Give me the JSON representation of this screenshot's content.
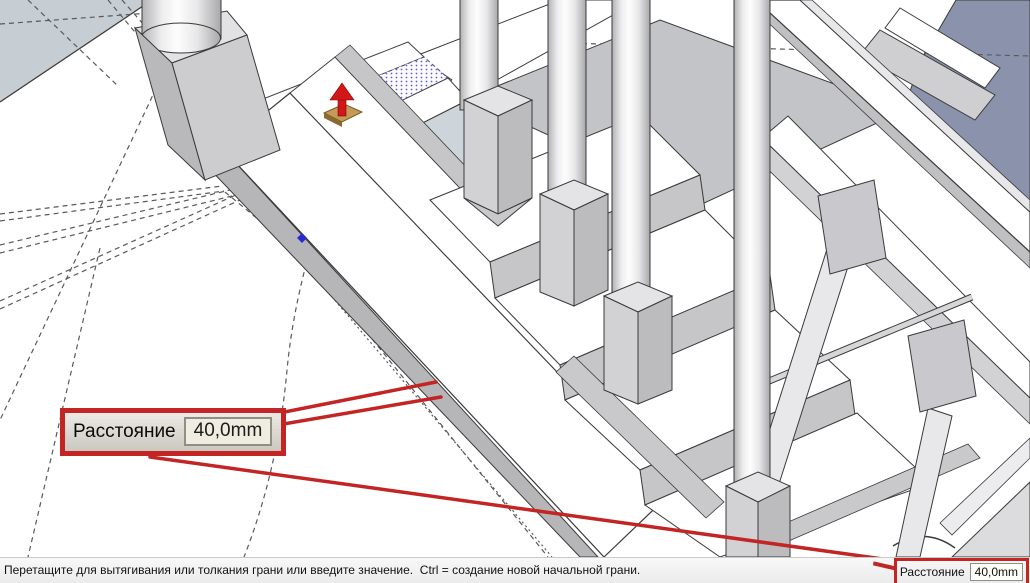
{
  "callout": {
    "label": "Расстояние",
    "value": "40,0mm"
  },
  "status_bar": {
    "message": "Перетащите для вытягивания или толкания грани или введите значение.  Ctrl = создание новой начальной грани.",
    "vcb": {
      "label": "Расстояние",
      "value": "40,0mm"
    }
  },
  "icons": {
    "push_pull_cursor": "push-pull-cursor-icon",
    "inference_point": "inference-point-icon"
  },
  "colors": {
    "annotation_red": "#c32424",
    "selection_dot_blue": "#4646c8",
    "inference_blue": "#2a2ad0",
    "face_white": "#ffffff",
    "face_gray": "#c6c6c9",
    "back_face_slate": "#8a93ab",
    "corner_face_light": "#c6cdd3",
    "landing_blue": "#cdd5da",
    "edge": "#3a3a3a",
    "statusbar_bg": "#f0f0f0",
    "vcb_field_bg": "#f0ecdf",
    "cursor_tan": "#c49a58",
    "arrow_red": "#d01818"
  }
}
